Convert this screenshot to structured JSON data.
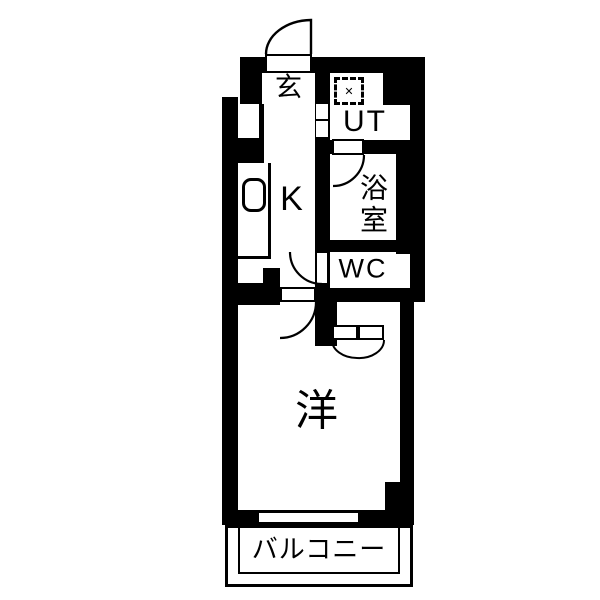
{
  "plan": {
    "type": "floorplan",
    "colors": {
      "wall": "#000000",
      "floor": "#ffffff",
      "line": "#000000"
    },
    "rooms": {
      "genkan": {
        "label": "玄"
      },
      "utility": {
        "label": "UT"
      },
      "bath": {
        "label": "浴室"
      },
      "toilet": {
        "label": "WC"
      },
      "kitchen": {
        "label": "K"
      },
      "main_room": {
        "label": "洋"
      },
      "balcony": {
        "label": "バルコニー"
      }
    },
    "icons": {
      "washing_machine_symbol": "✕"
    }
  }
}
